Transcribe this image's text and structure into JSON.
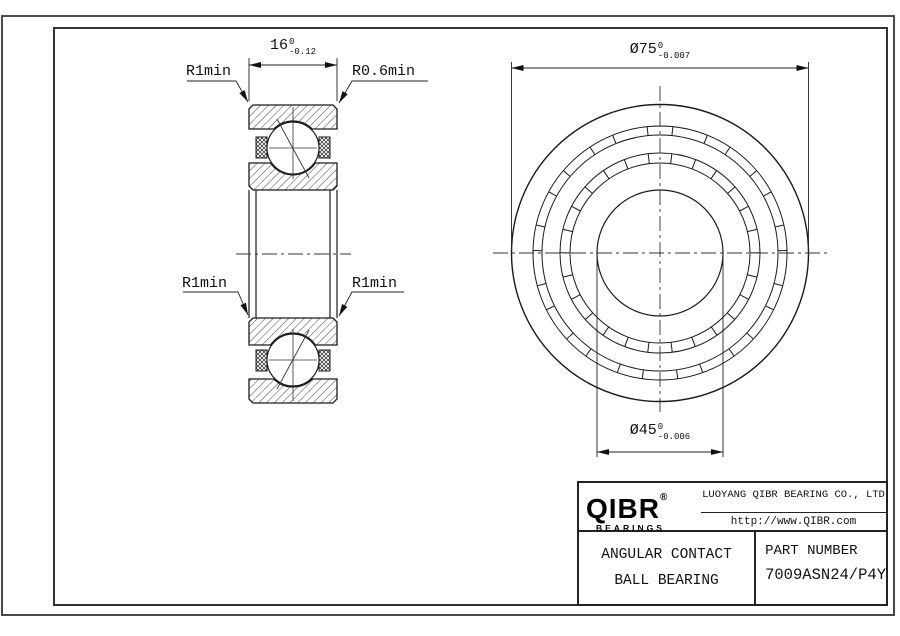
{
  "drawing_labels": {
    "width_dim": {
      "value": "16",
      "tol_upper": "0",
      "tol_lower": "-0.12"
    },
    "outer_dia_dim": {
      "value": "Ø75",
      "tol_upper": "0",
      "tol_lower": "-0.007"
    },
    "bore_dia_dim": {
      "value": "Ø45",
      "tol_upper": "0",
      "tol_lower": "-0.006"
    },
    "fillet_top_left": "R1min",
    "fillet_top_right": "R0.6min",
    "fillet_bottom_left": "R1min",
    "fillet_bottom_right": "R1min"
  },
  "title_block": {
    "logo_text": "QIBR",
    "logo_registered": "®",
    "logo_subtitle": "BEARINGS",
    "company_name": "LUOYANG QIBR BEARING CO., LTD",
    "website": "http://www.QIBR.com",
    "product_type_line1": "ANGULAR CONTACT",
    "product_type_line2": "BALL BEARING",
    "part_number_label": "PART NUMBER",
    "part_number": "7009ASN24/P4Y"
  }
}
